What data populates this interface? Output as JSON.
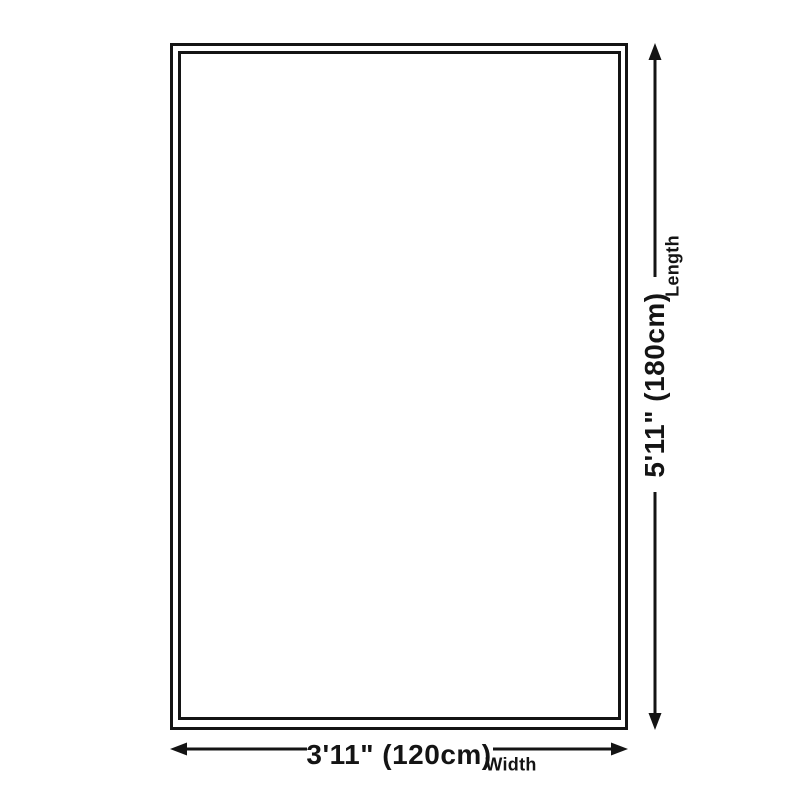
{
  "colors": {
    "line": "#141414",
    "background": "#ffffff"
  },
  "dimensions": {
    "length": {
      "value": "5'11\" (180cm)",
      "label": "Length"
    },
    "width": {
      "value": "3'11\" (120cm)",
      "label": "Width"
    }
  }
}
